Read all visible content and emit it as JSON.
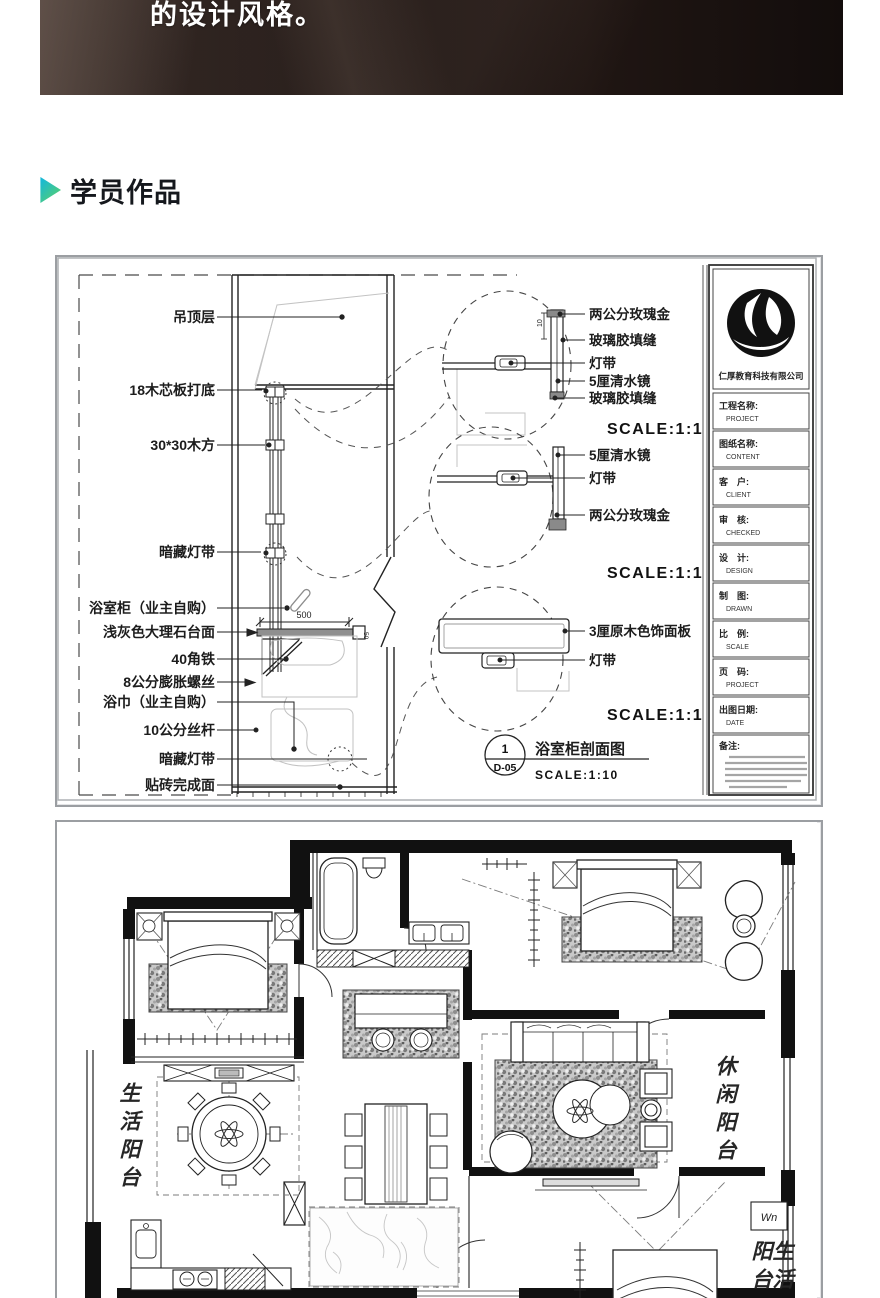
{
  "banner": {
    "caption": "的设计风格。"
  },
  "section": {
    "title": "学员作品"
  },
  "section_drawing": {
    "left_labels": [
      "吊顶层",
      "18木芯板打底",
      "30*30木方",
      "暗藏灯带",
      "浴室柜（业主自购）",
      "浅灰色大理石台面",
      "40角铁",
      "8公分膨胀螺丝",
      "浴巾（业主自购）",
      "10公分丝杆",
      "暗藏灯带",
      "贴砖完成面"
    ],
    "details": [
      {
        "labels": [
          "两公分玫瑰金",
          "玻璃胶填缝",
          "灯带",
          "5厘清水镜",
          "玻璃胶填缝"
        ],
        "scale": "SCALE:1:1",
        "dim": "10"
      },
      {
        "labels": [
          "5厘清水镜",
          "灯带",
          "两公分玫瑰金"
        ],
        "scale": "SCALE:1:1"
      },
      {
        "labels": [
          "3厘原木色饰面板",
          "灯带"
        ],
        "scale": "SCALE:1:1"
      }
    ],
    "dims": {
      "counter_width": "500",
      "counter_edge": "50"
    },
    "callout": {
      "number": "1",
      "sheet": "D-05",
      "title": "浴室柜剖面图",
      "scale": "SCALE:1:10"
    },
    "titleblock": {
      "company": "仁厚教育科技有限公司",
      "rows": [
        {
          "cn": "工程名称:",
          "en": "PROJECT"
        },
        {
          "cn": "图纸名称:",
          "en": "CONTENT"
        },
        {
          "cn": "客　户:",
          "en": "CLIENT"
        },
        {
          "cn": "审　核:",
          "en": "CHECKED"
        },
        {
          "cn": "设　计:",
          "en": "DESIGN"
        },
        {
          "cn": "制　图:",
          "en": "DRAWN"
        },
        {
          "cn": "比　例:",
          "en": "SCALE"
        },
        {
          "cn": "页　码:",
          "en": "PROJECT"
        },
        {
          "cn": "出图日期:",
          "en": "DATE"
        }
      ],
      "notes_label": "备注:"
    }
  },
  "floor_plan": {
    "labels": {
      "left_balcony": "生活阳台",
      "right_balcony": "休闲阳台",
      "bottom_balcony": "生活阳台",
      "washer": "Wn"
    }
  }
}
